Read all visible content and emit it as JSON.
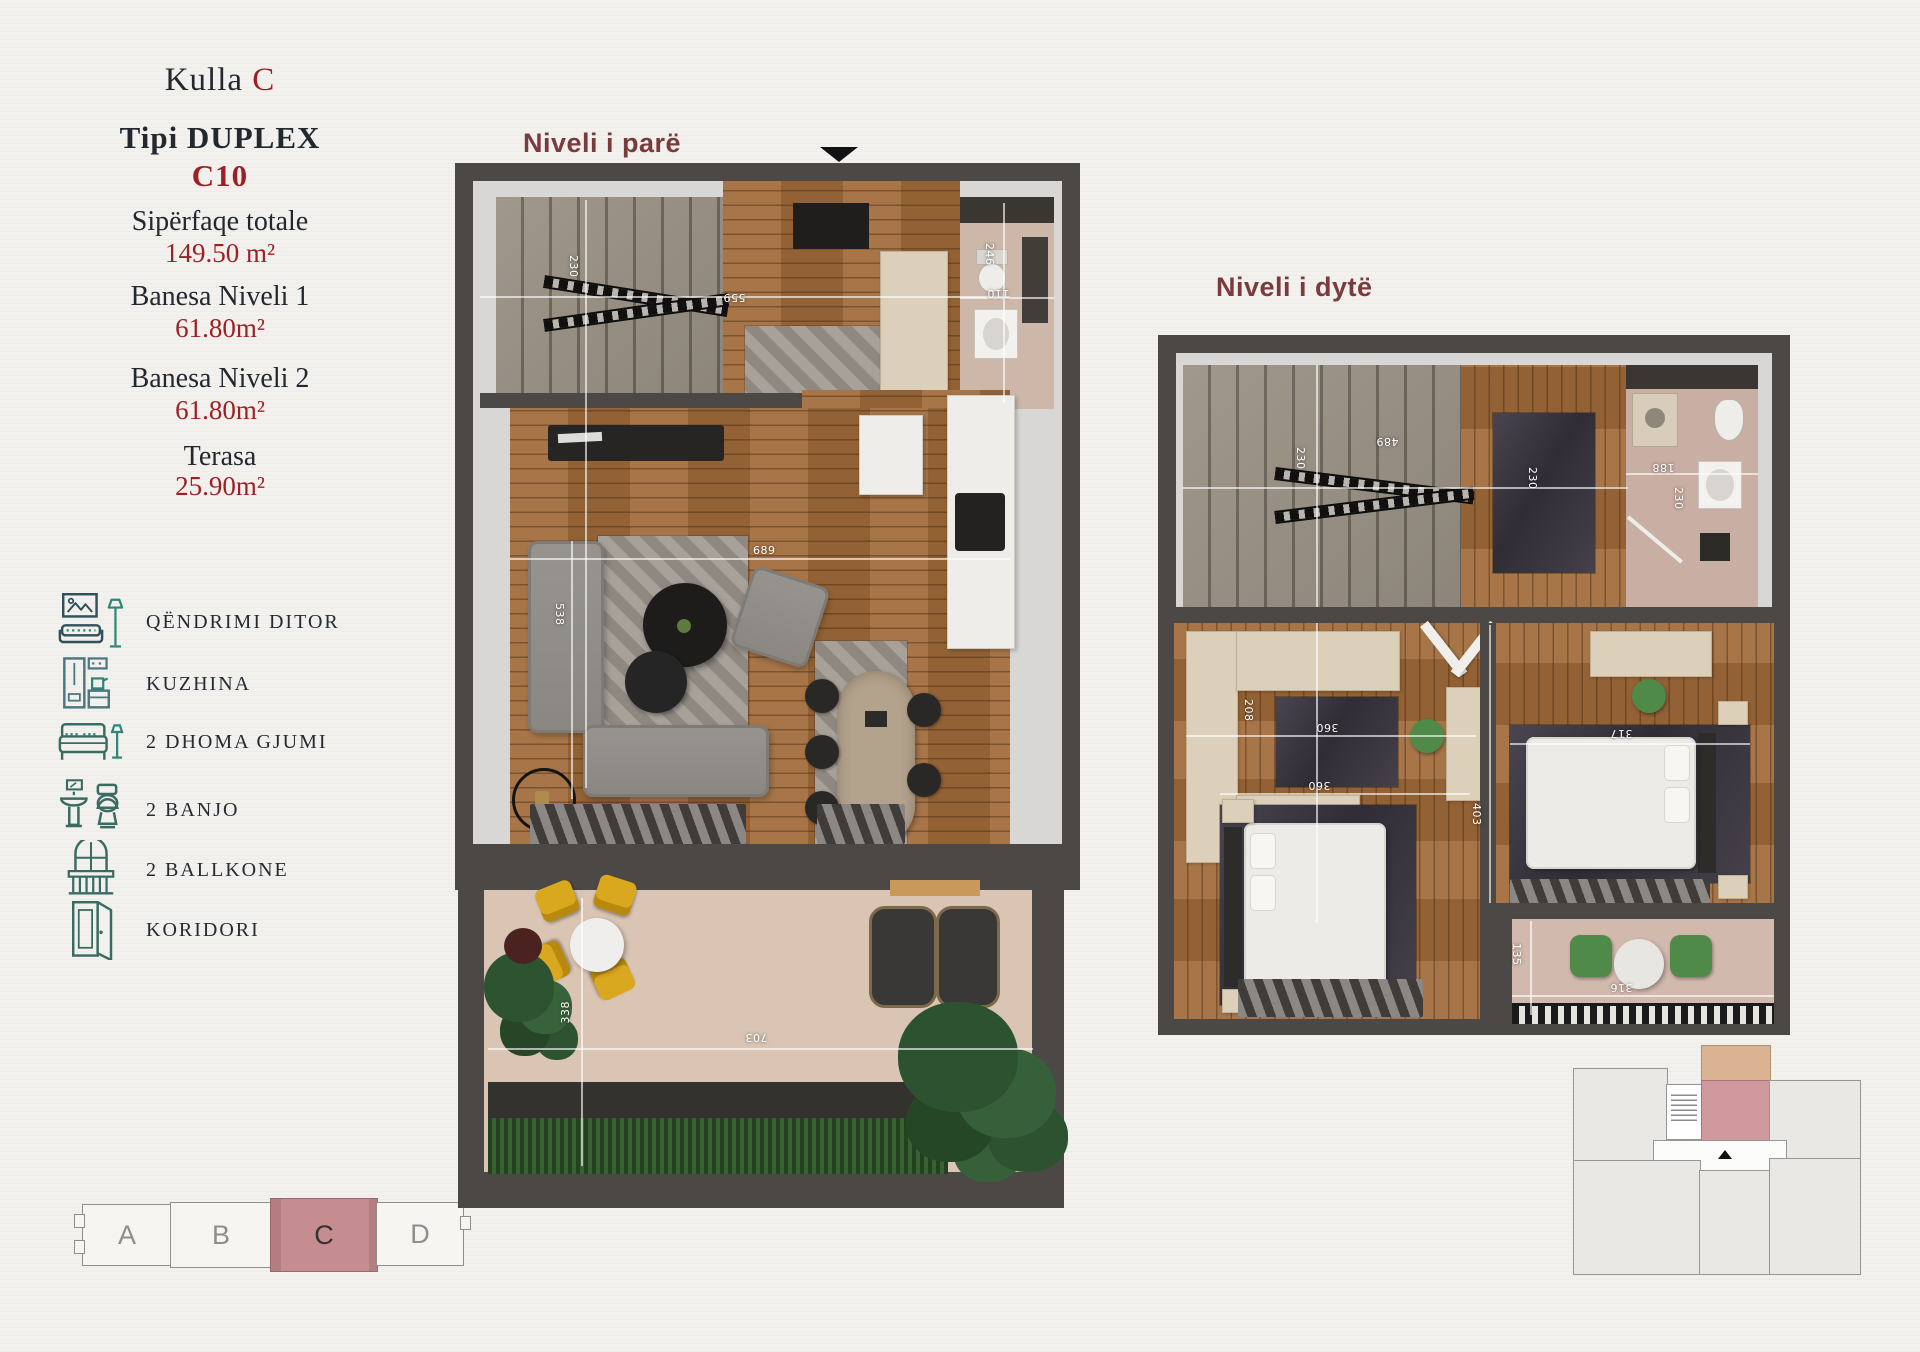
{
  "header": {
    "project": "Kulla",
    "tower": "C",
    "type_label": "Tipi DUPLEX",
    "type_code": "C10"
  },
  "stats": [
    {
      "label": "Sipërfaqe totale",
      "value": "149.50 m²"
    },
    {
      "label": "Banesa Niveli 1",
      "value": "61.80m²"
    },
    {
      "label": "Banesa Niveli 2",
      "value": "61.80m²"
    },
    {
      "label": "Terasa",
      "value": "25.90m²"
    }
  ],
  "legend": [
    {
      "icon": "living-room-icon",
      "label": "QËNDRIMI DITOR"
    },
    {
      "icon": "kitchen-icon",
      "label": "KUZHINA"
    },
    {
      "icon": "bed-icon",
      "label": "2 DHOMA GJUMI"
    },
    {
      "icon": "bath-icon",
      "label": "2 BANJO"
    },
    {
      "icon": "balcony-icon",
      "label": "2 BALLKONE"
    },
    {
      "icon": "door-icon",
      "label": "KORIDORI"
    }
  ],
  "building_strip": {
    "blocks": [
      {
        "label": "A"
      },
      {
        "label": "B"
      },
      {
        "label": "C"
      },
      {
        "label": "D"
      }
    ],
    "highlighted": "C"
  },
  "plan1": {
    "title": "Niveli i parë",
    "dims": {
      "stairs": "230",
      "hall": "559",
      "bath_depth": "246",
      "bath_width": "110",
      "living_width": "689",
      "living_depth": "538",
      "terrace_width": "703",
      "terrace_depth": "338"
    }
  },
  "plan2": {
    "title": "Niveli i dytë",
    "dims": {
      "stairs_depth": "230",
      "stairs_width": "489",
      "hall_depth": "230",
      "bath_width": "188",
      "bath_depth": "230",
      "closet_depth": "208",
      "closet_width": "360",
      "bedroom1_width": "360",
      "bedroom2_width": "317",
      "bedroom2_depth": "403",
      "balcony_depth": "135",
      "balcony_width": "316"
    }
  },
  "colors": {
    "accent_red": "#9c2125",
    "plan_title_maroon": "#7b3a3b",
    "highlight_pink": "#c58d90",
    "wall_gray": "#4c4846",
    "legend_teal": "#2f8577",
    "legend_navy": "#30505c"
  }
}
